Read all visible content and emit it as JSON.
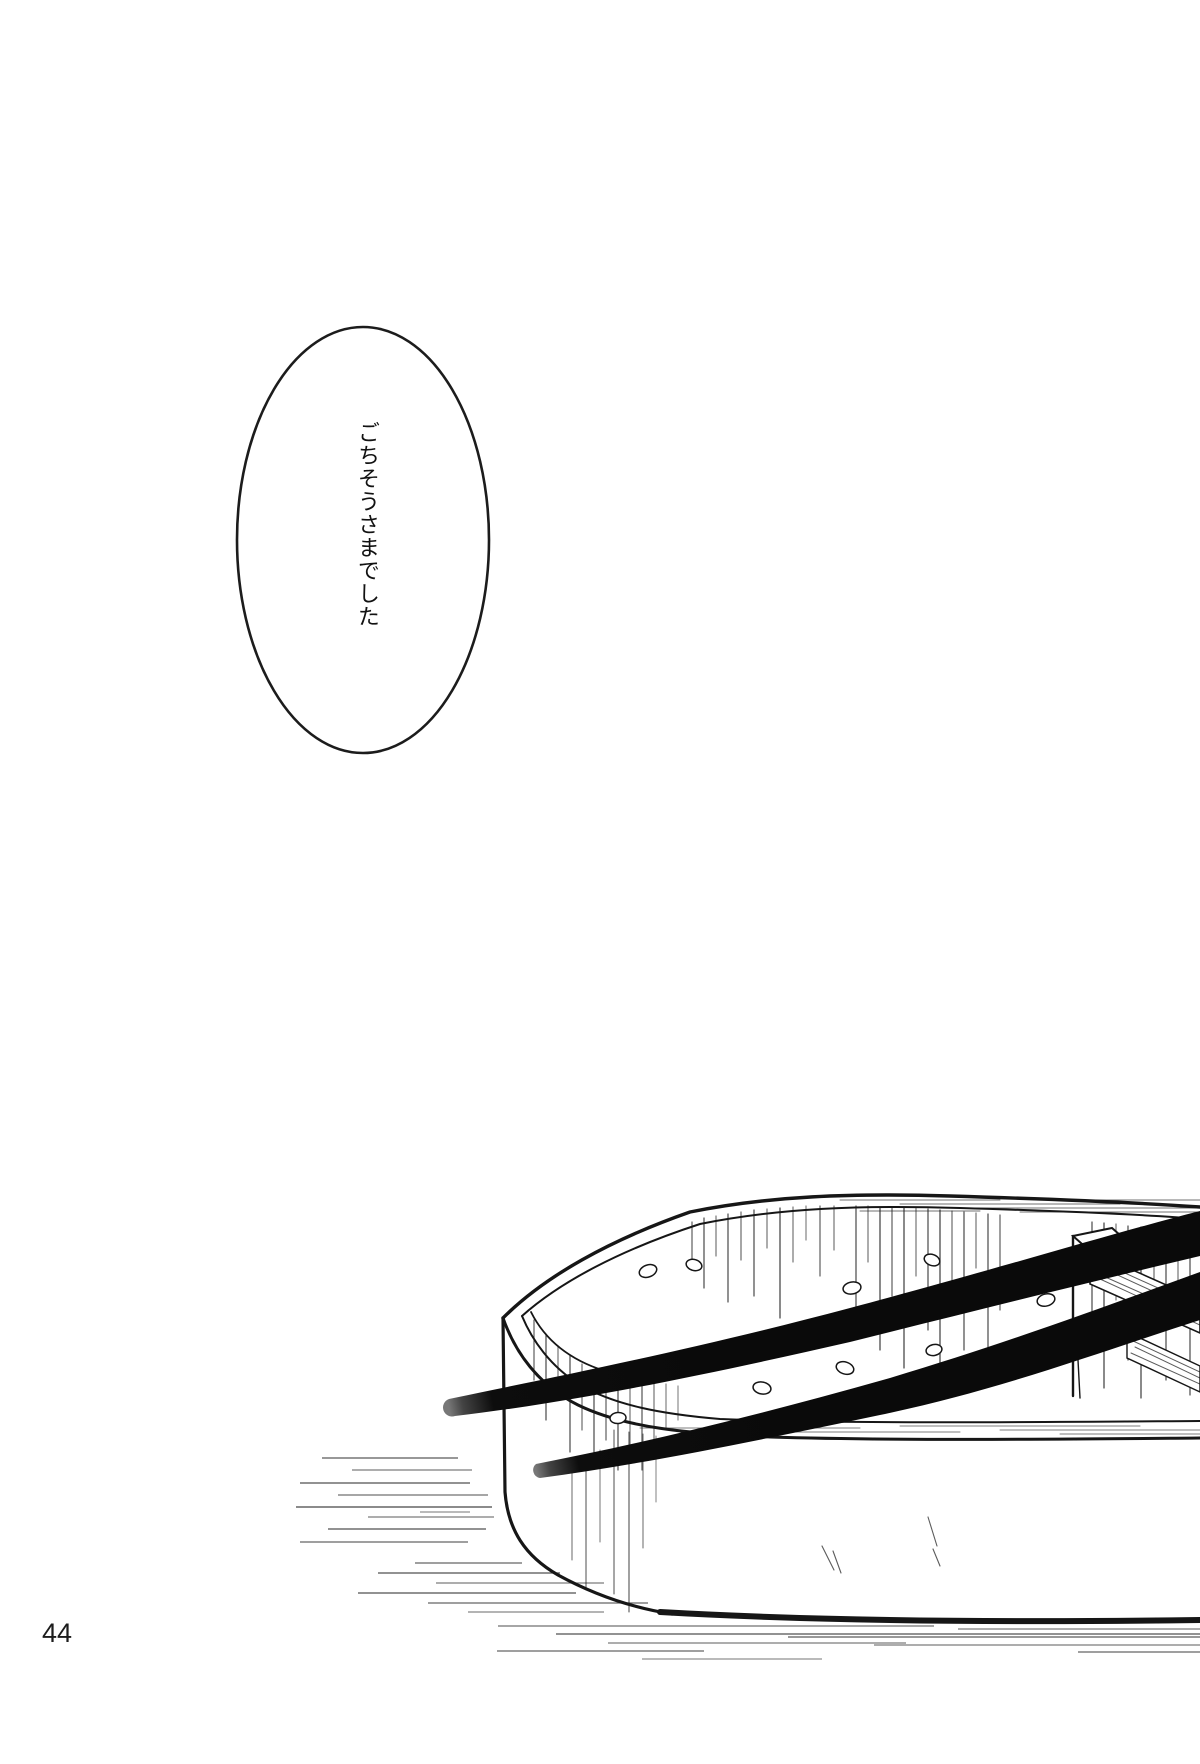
{
  "page": {
    "number": "44"
  },
  "speech_bubble": {
    "text": "ごちそうさまでした"
  },
  "colors": {
    "paper": "#ffffff",
    "ink": "#1a1a1a"
  }
}
